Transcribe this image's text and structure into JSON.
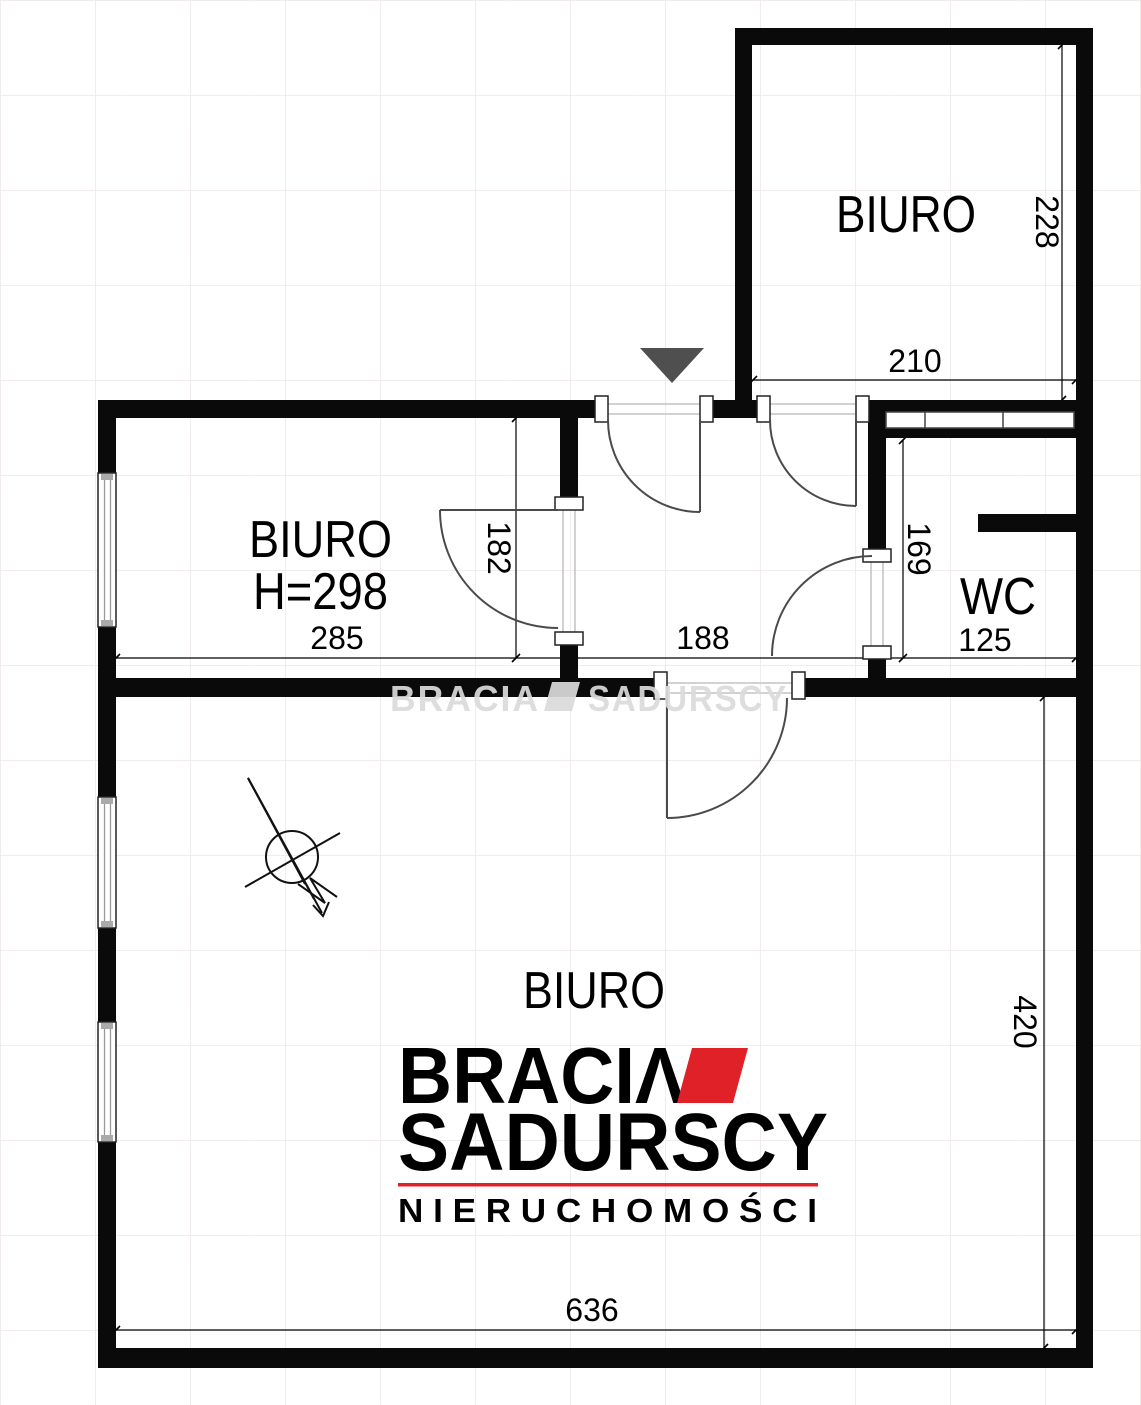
{
  "floorplan": {
    "rooms": {
      "office_top": {
        "label": "BIURO"
      },
      "office_left": {
        "label": "BIURO",
        "ceiling_height": "H=298"
      },
      "wc": {
        "label": "WC"
      },
      "office_main": {
        "label": "BIURO"
      }
    },
    "dimensions": {
      "office_top_width": "210",
      "office_top_height": "228",
      "office_left_width": "285",
      "hall_width": "188",
      "hall_height": "182",
      "wc_width": "125",
      "wc_height": "169",
      "office_main_width": "636",
      "office_main_height": "420"
    },
    "watermark": {
      "part1": "BRACIA",
      "part2": "SADURSCY"
    }
  },
  "logo": {
    "line1": "BRACIΛ",
    "line2": "SADURSCY",
    "line3": "N I E R U C H O M O Ś C I",
    "accent_color": "#E02128",
    "text_color": "#2B2930"
  }
}
